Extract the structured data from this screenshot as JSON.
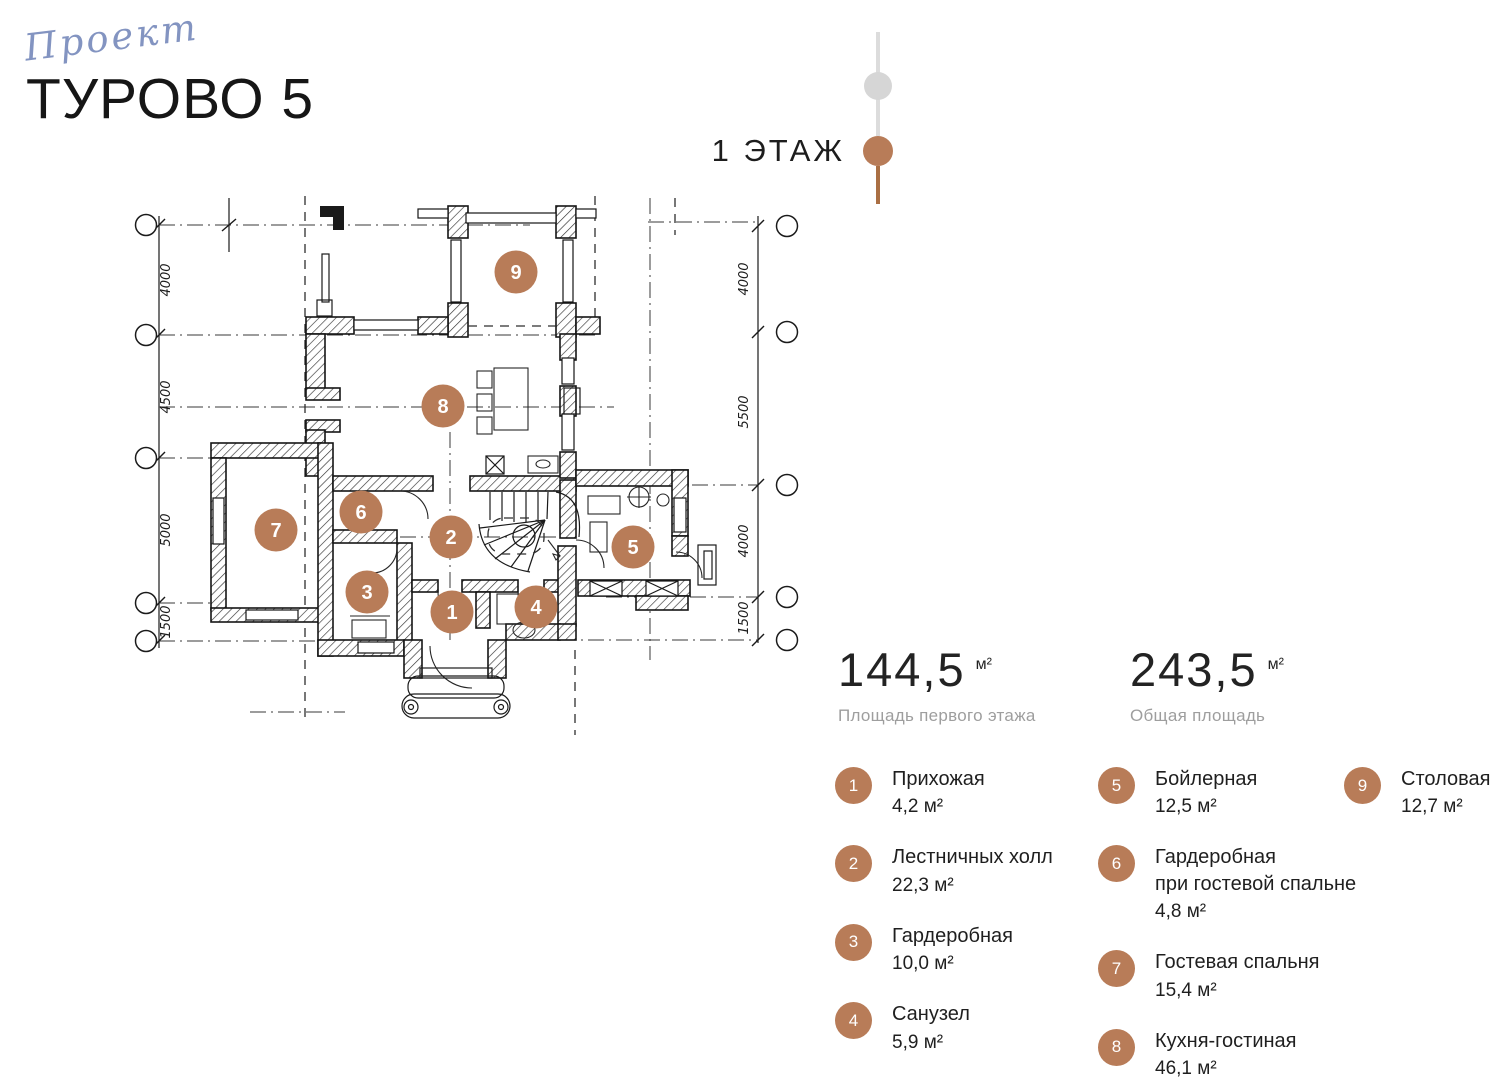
{
  "header": {
    "logo_script": "Проект",
    "title": "ТУРОВО 5"
  },
  "floor_label": "1 ЭТАЖ",
  "stats": [
    {
      "value": "144,5",
      "unit": "м²",
      "label": "Площадь первого этажа"
    },
    {
      "value": "243,5",
      "unit": "м²",
      "label": "Общая площадь"
    }
  ],
  "legend_columns": [
    [
      {
        "num": "1",
        "lines": [
          "Прихожая"
        ],
        "area": "4,2 м²"
      },
      {
        "num": "2",
        "lines": [
          "Лестничных холл"
        ],
        "area": "22,3 м²"
      },
      {
        "num": "3",
        "lines": [
          "Гардеробная"
        ],
        "area": "10,0 м²"
      },
      {
        "num": "4",
        "lines": [
          "Санузел"
        ],
        "area": "5,9 м²"
      }
    ],
    [
      {
        "num": "5",
        "lines": [
          "Бойлерная"
        ],
        "area": "12,5 м²"
      },
      {
        "num": "6",
        "lines": [
          "Гардеробная",
          "при гостевой спальне"
        ],
        "area": "4,8 м²"
      },
      {
        "num": "7",
        "lines": [
          "Гостевая спальня"
        ],
        "area": "15,4 м²"
      },
      {
        "num": "8",
        "lines": [
          "Кухня-гостиная"
        ],
        "area": "46,1 м²"
      }
    ],
    [
      {
        "num": "9",
        "lines": [
          "Столовая"
        ],
        "area": "12,7 м²"
      }
    ]
  ],
  "plan": {
    "markers": [
      {
        "num": "1",
        "x": 452,
        "y": 612
      },
      {
        "num": "2",
        "x": 451,
        "y": 537
      },
      {
        "num": "3",
        "x": 367,
        "y": 592
      },
      {
        "num": "4",
        "x": 536,
        "y": 607
      },
      {
        "num": "5",
        "x": 633,
        "y": 547
      },
      {
        "num": "6",
        "x": 361,
        "y": 512
      },
      {
        "num": "7",
        "x": 276,
        "y": 530
      },
      {
        "num": "8",
        "x": 443,
        "y": 406
      },
      {
        "num": "9",
        "x": 516,
        "y": 272
      }
    ],
    "dims_left": [
      {
        "label": "4000",
        "x": 170,
        "y": 280
      },
      {
        "label": "4500",
        "x": 170,
        "y": 397
      },
      {
        "label": "5000",
        "x": 170,
        "y": 530
      },
      {
        "label": "1500",
        "x": 170,
        "y": 622
      }
    ],
    "dims_right": [
      {
        "label": "4000",
        "x": 748,
        "y": 279
      },
      {
        "label": "5500",
        "x": 748,
        "y": 412
      },
      {
        "label": "4000",
        "x": 748,
        "y": 541
      },
      {
        "label": "1500",
        "x": 748,
        "y": 618
      }
    ]
  },
  "colors": {
    "copper": "#b87c58",
    "timeline_gray": "#dcdcdc",
    "timeline_brown": "#aa6f44",
    "logo_blue": "#8394c1",
    "ink": "#1c1c1c",
    "muted": "#9e9e9e"
  }
}
